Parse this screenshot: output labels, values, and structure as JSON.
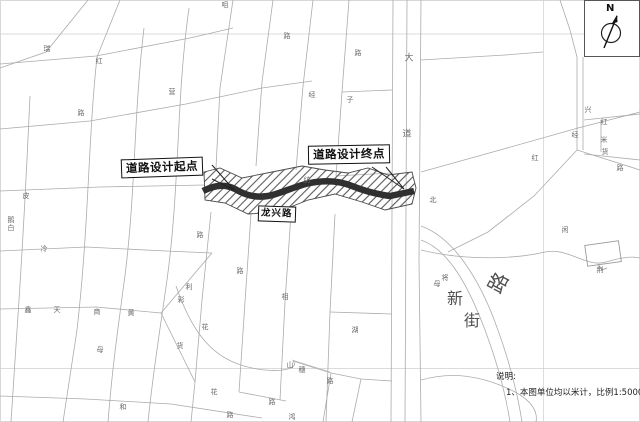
{
  "callouts": {
    "start": "道路设计起点",
    "end": "道路设计终点",
    "road_name": "龙兴路"
  },
  "north": {
    "label": "N"
  },
  "notes": {
    "title": "说明:",
    "line1": "1、本图单位均以米计，比例1:5000。"
  },
  "map": {
    "street_labels": [
      {
        "t": "路",
        "x": 497,
        "y": 282,
        "s": 20,
        "r": -62,
        "big": true
      },
      {
        "t": "新",
        "x": 455,
        "y": 297,
        "s": 16,
        "r": 0,
        "big": true
      },
      {
        "t": "街",
        "x": 472,
        "y": 319,
        "s": 16,
        "r": 0,
        "big": true
      },
      {
        "t": "大",
        "x": 409,
        "y": 57,
        "s": 9
      },
      {
        "t": "道",
        "x": 407,
        "y": 133,
        "s": 9
      },
      {
        "t": "咀",
        "x": 225,
        "y": 5
      },
      {
        "t": "瑞",
        "x": 47,
        "y": 49
      },
      {
        "t": "红",
        "x": 99,
        "y": 61
      },
      {
        "t": "营",
        "x": 172,
        "y": 92
      },
      {
        "t": "经",
        "x": 312,
        "y": 95
      },
      {
        "t": "路",
        "x": 287,
        "y": 36
      },
      {
        "t": "路",
        "x": 358,
        "y": 53
      },
      {
        "t": "子",
        "x": 350,
        "y": 100
      },
      {
        "t": "路",
        "x": 81,
        "y": 113
      },
      {
        "t": "丰",
        "x": 190,
        "y": 173
      },
      {
        "t": "纺",
        "x": 307,
        "y": 180
      },
      {
        "t": "皮",
        "x": 26,
        "y": 196
      },
      {
        "t": "鹅",
        "x": 11,
        "y": 220
      },
      {
        "t": "白",
        "x": 11,
        "y": 228
      },
      {
        "t": "冷",
        "x": 44,
        "y": 249
      },
      {
        "t": "路",
        "x": 200,
        "y": 235
      },
      {
        "t": "北",
        "x": 433,
        "y": 200
      },
      {
        "t": "路",
        "x": 240,
        "y": 271
      },
      {
        "t": "利",
        "x": 189,
        "y": 287
      },
      {
        "t": "彩",
        "x": 181,
        "y": 300
      },
      {
        "t": "相",
        "x": 285,
        "y": 297
      },
      {
        "t": "花",
        "x": 205,
        "y": 327
      },
      {
        "t": "货",
        "x": 180,
        "y": 346
      },
      {
        "t": "鑫",
        "x": 28,
        "y": 310
      },
      {
        "t": "天",
        "x": 57,
        "y": 310
      },
      {
        "t": "商",
        "x": 97,
        "y": 312
      },
      {
        "t": "黄",
        "x": 131,
        "y": 313
      },
      {
        "t": "母",
        "x": 100,
        "y": 350
      },
      {
        "t": "山",
        "x": 290,
        "y": 365
      },
      {
        "t": "穗",
        "x": 302,
        "y": 370
      },
      {
        "t": "路",
        "x": 330,
        "y": 381
      },
      {
        "t": "花",
        "x": 214,
        "y": 392
      },
      {
        "t": "路",
        "x": 272,
        "y": 402
      },
      {
        "t": "路",
        "x": 230,
        "y": 415
      },
      {
        "t": "和",
        "x": 123,
        "y": 407
      },
      {
        "t": "鸿",
        "x": 292,
        "y": 417
      },
      {
        "t": "红",
        "x": 535,
        "y": 158
      },
      {
        "t": "兴",
        "x": 588,
        "y": 110
      },
      {
        "t": "红",
        "x": 604,
        "y": 122
      },
      {
        "t": "经",
        "x": 575,
        "y": 135
      },
      {
        "t": "米",
        "x": 604,
        "y": 140
      },
      {
        "t": "货",
        "x": 605,
        "y": 152
      },
      {
        "t": "路",
        "x": 620,
        "y": 168
      },
      {
        "t": "闲",
        "x": 565,
        "y": 230
      },
      {
        "t": "荆",
        "x": 600,
        "y": 270
      },
      {
        "t": "将",
        "x": 445,
        "y": 278
      },
      {
        "t": "母",
        "x": 437,
        "y": 284
      },
      {
        "t": "湖",
        "x": 355,
        "y": 330
      }
    ]
  },
  "colors": {
    "road": "#ababab",
    "corridor_core": "#303030",
    "hatch": "#5a5a5a",
    "callout_border": "#111111",
    "background": "#ffffff"
  }
}
